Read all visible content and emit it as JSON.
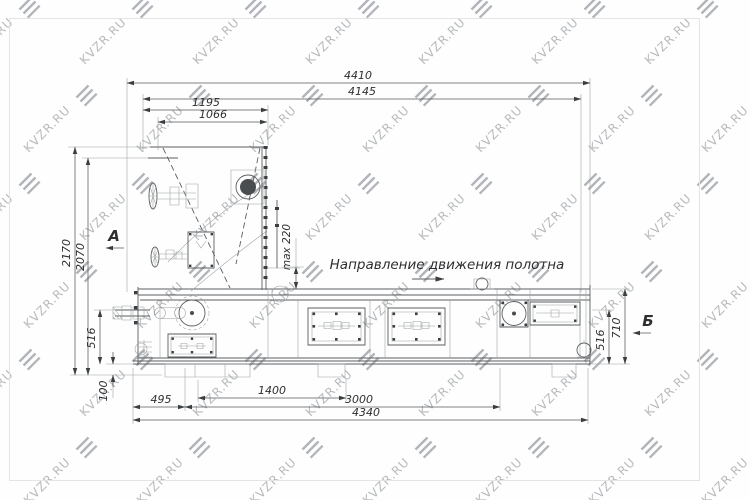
{
  "watermark": {
    "text": "KVZR.RU",
    "color": "#b7babd"
  },
  "drawing": {
    "direction_note": "Направление движения полотна",
    "view_a": "А",
    "view_b": "Б",
    "dims": {
      "top_overall": "4410",
      "top_inner": "4145",
      "hopper_outer": "1195",
      "hopper_inner": "1066",
      "left_height_outer": "2170",
      "left_height_inner": "2070",
      "left_516": "516",
      "left_100": "100",
      "max_gap": "max 220",
      "bottom_495": "495",
      "bottom_1400": "1400",
      "bottom_3000": "3000",
      "bottom_4340": "4340",
      "right_516": "516",
      "right_710": "710"
    }
  }
}
